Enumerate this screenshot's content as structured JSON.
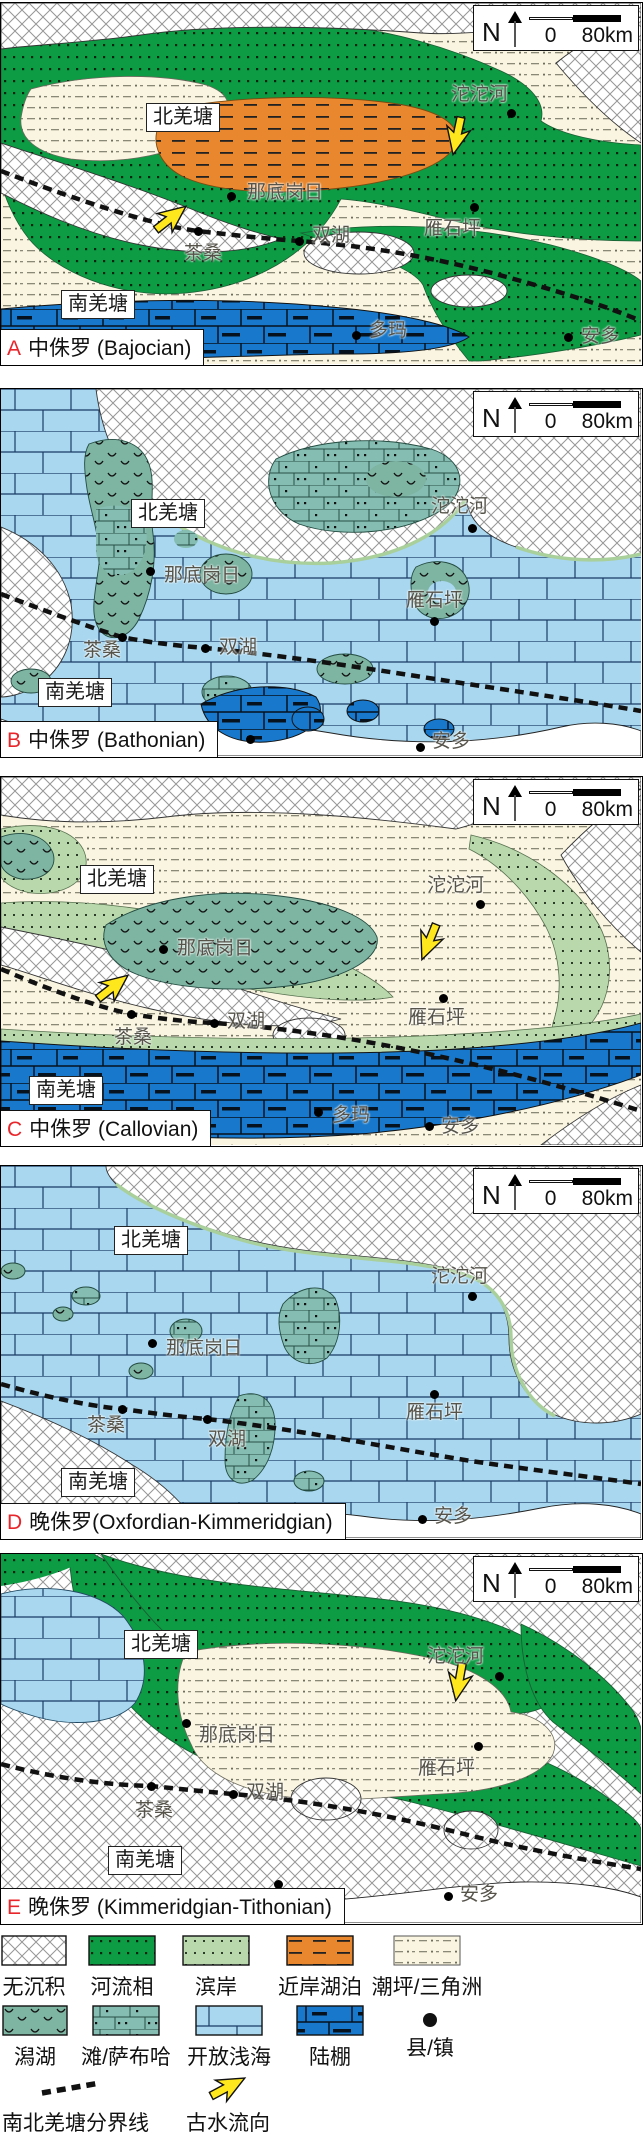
{
  "scalebar": {
    "north": "N",
    "zero": "0",
    "distance": "80km"
  },
  "panels": [
    {
      "id": "A",
      "stage": "中侏罗 (Bajocian)",
      "regions": [
        {
          "name": "北羌塘",
          "x": 145,
          "y": 100
        },
        {
          "name": "南羌塘",
          "x": 60,
          "y": 287
        }
      ],
      "places": [
        {
          "name": "沱沱河",
          "dot": [
            510,
            110
          ],
          "label": [
            450,
            82
          ]
        },
        {
          "name": "那底岗日",
          "dot": [
            230,
            193
          ],
          "label": [
            246,
            180
          ]
        },
        {
          "name": "双湖",
          "dot": [
            298,
            238
          ],
          "label": [
            311,
            223
          ]
        },
        {
          "name": "茶桑",
          "dot": [
            197,
            228
          ],
          "label": [
            183,
            241
          ]
        },
        {
          "name": "雁石坪",
          "dot": [
            473,
            204
          ],
          "label": [
            423,
            216
          ]
        },
        {
          "name": "多玛",
          "dot": [
            355,
            332
          ],
          "label": [
            368,
            318
          ]
        },
        {
          "name": "安多",
          "dot": [
            567,
            334
          ],
          "label": [
            580,
            324
          ]
        }
      ]
    },
    {
      "id": "B",
      "stage": "中侏罗 (Bathonian)",
      "regions": [
        {
          "name": "北羌塘",
          "x": 130,
          "y": 110
        },
        {
          "name": "南羌塘",
          "x": 37,
          "y": 289
        }
      ],
      "places": [
        {
          "name": "沱沱河",
          "dot": [
            471,
            139
          ],
          "label": [
            430,
            108
          ]
        },
        {
          "name": "那底岗日",
          "dot": [
            149,
            182
          ],
          "label": [
            163,
            177
          ]
        },
        {
          "name": "雁石坪",
          "dot": [
            433,
            232
          ],
          "label": [
            405,
            202
          ]
        },
        {
          "name": "茶桑",
          "dot": [
            121,
            248
          ],
          "label": [
            82,
            252
          ]
        },
        {
          "name": "双湖",
          "dot": [
            204,
            259
          ],
          "label": [
            218,
            249
          ]
        },
        {
          "name": "",
          "dot": [
            249,
            350
          ],
          "label": null
        },
        {
          "name": "安多",
          "dot": [
            419,
            358
          ],
          "label": [
            431,
            343
          ]
        }
      ]
    },
    {
      "id": "C",
      "stage": "中侏罗 (Callovian)",
      "regions": [
        {
          "name": "北羌塘",
          "x": 79,
          "y": 88
        },
        {
          "name": "南羌塘",
          "x": 28,
          "y": 299
        }
      ],
      "places": [
        {
          "name": "沱沱河",
          "dot": [
            479,
            127
          ],
          "label": [
            426,
            99
          ]
        },
        {
          "name": "那底岗日",
          "dot": [
            162,
            172
          ],
          "label": [
            176,
            162
          ]
        },
        {
          "name": "雁石坪",
          "dot": [
            442,
            221
          ],
          "label": [
            407,
            231
          ]
        },
        {
          "name": "茶桑",
          "dot": [
            130,
            237
          ],
          "label": [
            113,
            251
          ]
        },
        {
          "name": "双湖",
          "dot": [
            213,
            246
          ],
          "label": [
            226,
            235
          ]
        },
        {
          "name": "多玛",
          "dot": [
            317,
            335
          ],
          "label": [
            331,
            329
          ]
        },
        {
          "name": "安多",
          "dot": [
            428,
            349
          ],
          "label": [
            440,
            340
          ]
        }
      ]
    },
    {
      "id": "D",
      "stage": "晚侏罗(Oxfordian-Kimmeridgian)",
      "regions": [
        {
          "name": "北羌塘",
          "x": 113,
          "y": 60
        },
        {
          "name": "南羌塘",
          "x": 60,
          "y": 302
        }
      ],
      "places": [
        {
          "name": "沱沱河",
          "dot": [
            471,
            130
          ],
          "label": [
            430,
            101
          ]
        },
        {
          "name": "那底岗日",
          "dot": [
            151,
            177
          ],
          "label": [
            165,
            173
          ]
        },
        {
          "name": "雁石坪",
          "dot": [
            433,
            228
          ],
          "label": [
            405,
            237
          ]
        },
        {
          "name": "茶桑",
          "dot": [
            121,
            243
          ],
          "label": [
            86,
            250
          ]
        },
        {
          "name": "双湖",
          "dot": [
            206,
            253
          ],
          "label": [
            207,
            264
          ]
        },
        {
          "name": "安多",
          "dot": [
            421,
            353
          ],
          "label": [
            433,
            341
          ]
        }
      ]
    },
    {
      "id": "E",
      "stage": "晚侏罗 (Kimmeridgian-Tithonian)",
      "regions": [
        {
          "name": "北羌塘",
          "x": 123,
          "y": 76
        },
        {
          "name": "南羌塘",
          "x": 107,
          "y": 292
        }
      ],
      "places": [
        {
          "name": "沱沱河",
          "dot": [
            498,
            122
          ],
          "label": [
            426,
            93
          ]
        },
        {
          "name": "那底岗日",
          "dot": [
            185,
            169
          ],
          "label": [
            198,
            172
          ]
        },
        {
          "name": "雁石坪",
          "dot": [
            477,
            192
          ],
          "label": [
            417,
            205
          ]
        },
        {
          "name": "茶桑",
          "dot": [
            150,
            232
          ],
          "label": [
            134,
            247
          ]
        },
        {
          "name": "双湖",
          "dot": [
            232,
            240
          ],
          "label": [
            245,
            229
          ]
        },
        {
          "name": "",
          "dot": [
            277,
            330
          ],
          "label": null
        },
        {
          "name": "安多",
          "dot": [
            447,
            342
          ],
          "label": [
            459,
            331
          ]
        }
      ]
    }
  ],
  "legend": {
    "items": [
      {
        "label": "无沉积",
        "swatch": "nodep"
      },
      {
        "label": "河流相",
        "swatch": "fluvial"
      },
      {
        "label": "滨岸",
        "swatch": "shore"
      },
      {
        "label": "近岸湖泊",
        "swatch": "lake"
      },
      {
        "label": "潮坪/三角洲",
        "swatch": "tidal"
      },
      {
        "label": "潟湖",
        "swatch": "lagoon"
      },
      {
        "label": "滩/萨布哈",
        "swatch": "sabkha"
      },
      {
        "label": "开放浅海",
        "swatch": "sea"
      },
      {
        "label": "陆棚",
        "swatch": "shelf"
      },
      {
        "label": "县/镇",
        "swatch": "town"
      }
    ],
    "boundary_label": "南北羌塘分界线",
    "paleocurrent_label": "古水流向"
  },
  "colors": {
    "fluvial": "#0d9b44",
    "shore": "#b9d9ad",
    "nearshore_lake": "#e8872d",
    "tidal_flat_delta": "#faf5e1",
    "lagoon": "#7eb4a2",
    "sabkha": "#85bdb2",
    "open_shallow_sea": "#a8d7ef",
    "shelf": "#1879cc",
    "no_deposition": "#ffffff",
    "boundary_line": "#111111",
    "paleocurrent_arrow": "#ffe71e",
    "panel_letter": "#e8252a"
  }
}
